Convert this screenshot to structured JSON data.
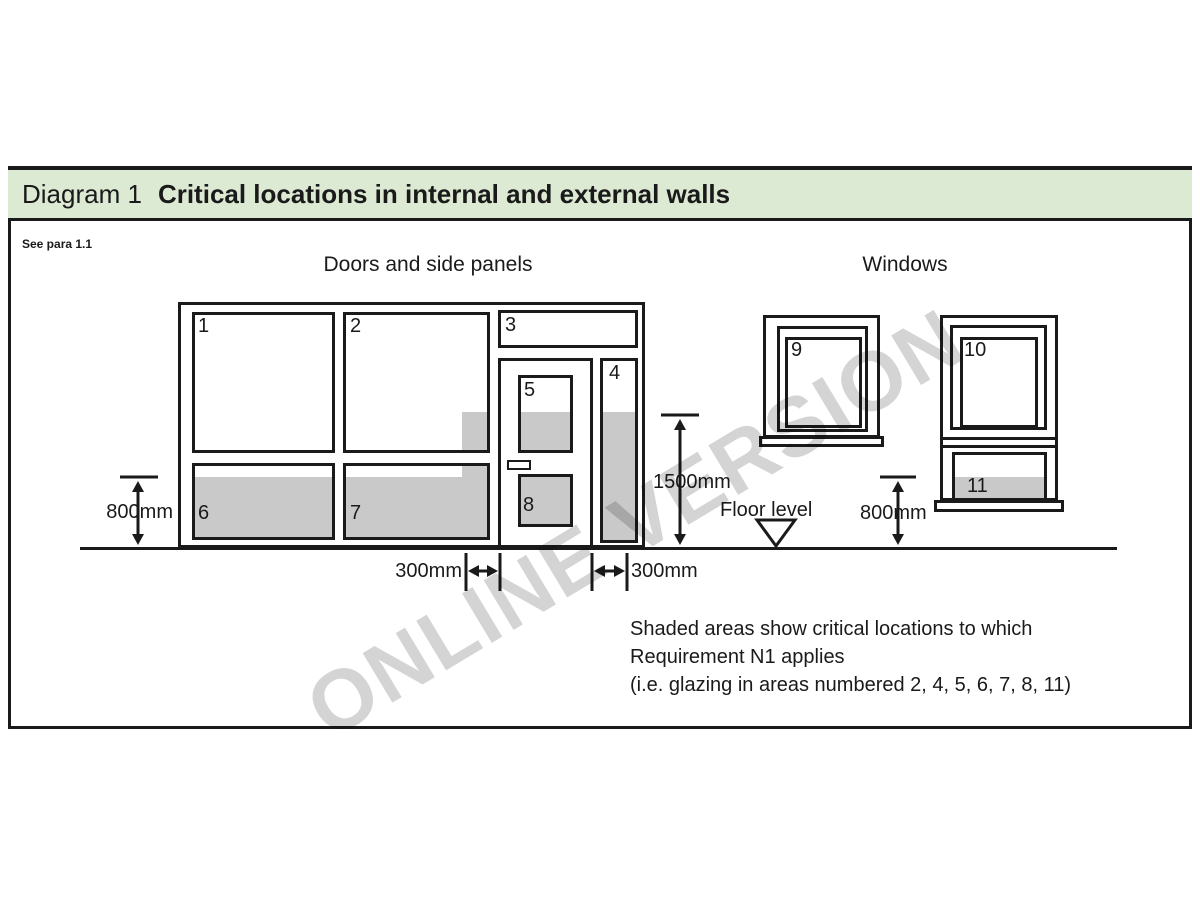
{
  "header": {
    "label": "Diagram 1",
    "title": "Critical locations in internal and external walls"
  },
  "ref_note": "See para 1.1",
  "sections": {
    "doors": "Doors and side panels",
    "windows": "Windows"
  },
  "panel_labels": {
    "p1": "1",
    "p2": "2",
    "p3": "3",
    "p4": "4",
    "p5": "5",
    "p6": "6",
    "p7": "7",
    "p8": "8",
    "p9": "9",
    "p10": "10",
    "p11": "11"
  },
  "dimensions": {
    "left_800": "800mm",
    "height_1500": "1500mm",
    "right_800": "800mm",
    "left_300": "300mm",
    "right_300": "300mm",
    "floor_level": "Floor level"
  },
  "note_lines": {
    "line1": "Shaded areas show critical locations to which",
    "line2": "Requirement N1 applies",
    "line3": "(i.e. glazing in areas numbered 2, 4, 5, 6, 7, 8, 11)"
  },
  "watermark": "ONLINE VERSION",
  "colors": {
    "band_green": "#dce9d3",
    "shade_gray": "#c9c9c9",
    "line": "#1a1a1a",
    "watermark_gray": "#d4d4d4"
  }
}
